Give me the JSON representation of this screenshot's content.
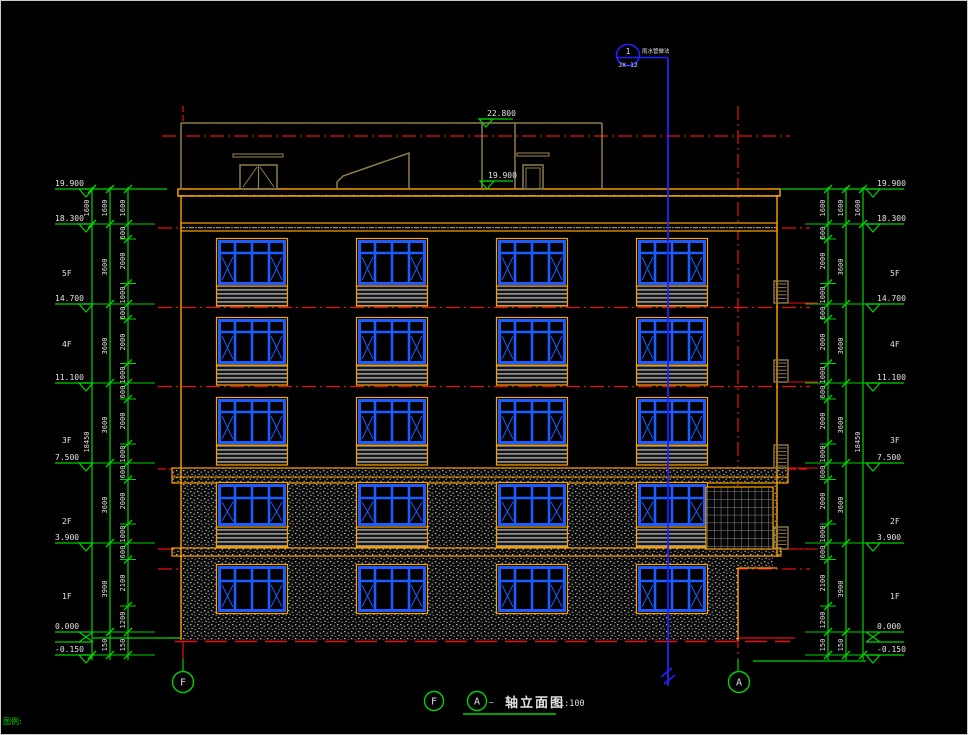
{
  "corner_note": "图例:",
  "roof_elev": "22.800",
  "callout": {
    "number": "1",
    "code": "JX-12",
    "note": "雨水管做法"
  },
  "elevations": [
    "19.900",
    "18.300",
    "14.700",
    "11.100",
    "7.500",
    "3.900",
    "0.000",
    "-0.150"
  ],
  "floors": [
    "5F",
    "4F",
    "3F",
    "2F",
    "1F"
  ],
  "dims": {
    "outer": [
      "1600",
      "600",
      "2000",
      "1000",
      "600",
      "2000",
      "1000",
      "600",
      "2000",
      "1000",
      "600",
      "2000",
      "1000",
      "600",
      "2100",
      "1200",
      "150"
    ],
    "mid": [
      "1600",
      "3600",
      "3600",
      "3600",
      "3600",
      "3900",
      "150"
    ],
    "inner": [
      "1600",
      "18450"
    ]
  },
  "footer": {
    "axis_left": "F",
    "axis_right": "A",
    "title_axis_f": "F",
    "title_axis_a": "A",
    "tilde": "~",
    "title": "轴立面图",
    "scale": "1:100"
  },
  "colors": {
    "dim_green": "#00d400",
    "red": "#e81010",
    "window_blue": "#1a5cff",
    "pipe_blue": "#2222ff",
    "orange": "#ffa200",
    "tan": "#8f7d4a",
    "text_white": "#e2e2e2"
  }
}
